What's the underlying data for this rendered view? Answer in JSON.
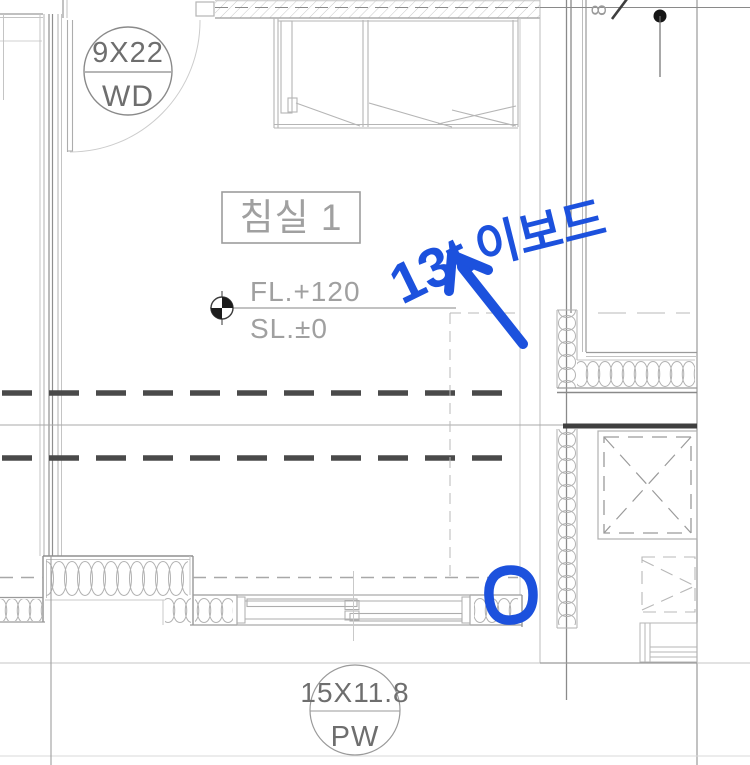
{
  "drawing": {
    "room_label": "침실 1",
    "levels": {
      "floor": "FL.+120",
      "slab": "SL.±0"
    },
    "door_tag": {
      "size": "9X22",
      "code": "WD"
    },
    "window_tag": {
      "size": "15X11.8",
      "code": "PW"
    },
    "grid_bubble": "8",
    "annotation": {
      "thickness": "13t",
      "material": "이보드"
    },
    "colors": {
      "annotation_blue": "#1c51dd",
      "heavy_dash": "#4a4a4a",
      "cad_light": "#c4c4c4",
      "cad_mid": "#9a9a9a",
      "cad_dark": "#555555"
    }
  }
}
